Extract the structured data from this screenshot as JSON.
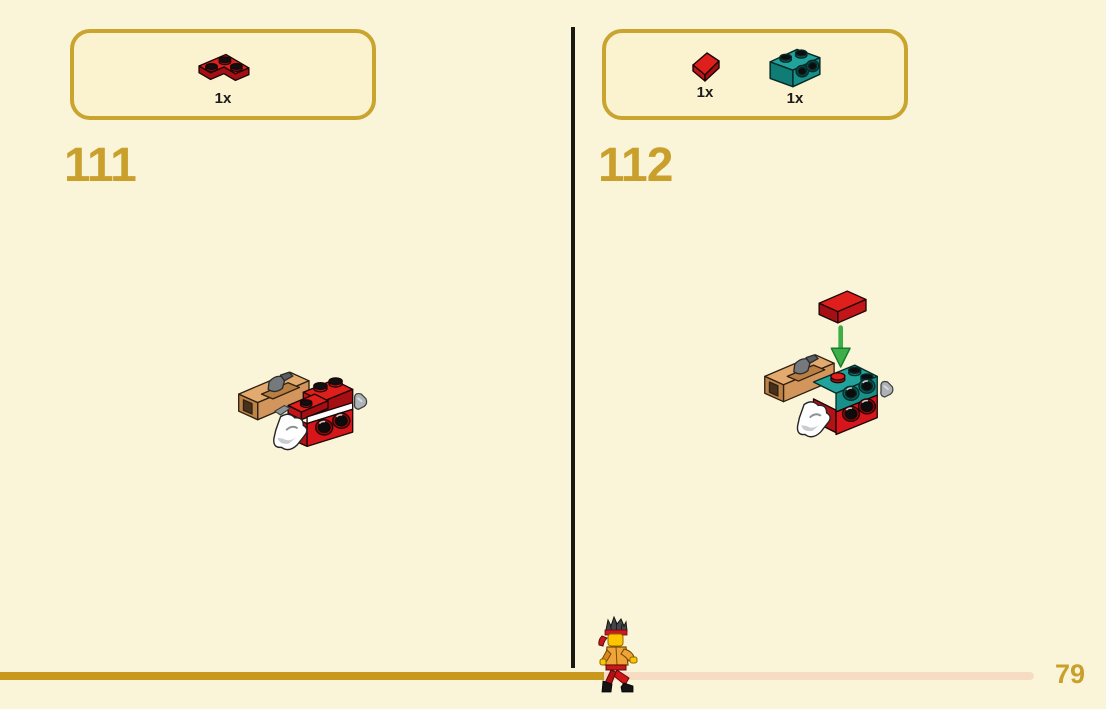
{
  "page": {
    "kind": "LEGO building instructions page",
    "page_number": "79"
  },
  "colors": {
    "background": "#FAF5D9",
    "panel_fill": "#FBF2CF",
    "gold_accent": "#C9A02C",
    "progress_done": "#C8991D",
    "progress_remaining": "#F6DCC2",
    "divider": "#191912",
    "brick_red": "#D6161B",
    "brick_teal": "#1A9B94",
    "brick_tan": "#DFA268",
    "arrow_green": "#3FAE49"
  },
  "steps": [
    {
      "number": "111",
      "parts": [
        {
          "piece": "red corner plate 2x2",
          "count": "1x"
        }
      ]
    },
    {
      "number": "112",
      "parts": [
        {
          "piece": "red slope 1x1",
          "count": "1x"
        },
        {
          "piece": "teal bracket 1x2",
          "count": "1x"
        }
      ]
    }
  ]
}
